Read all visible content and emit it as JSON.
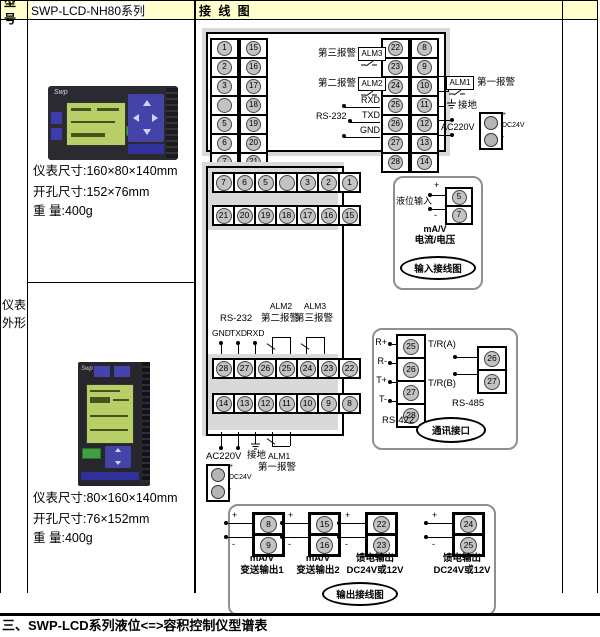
{
  "header": {
    "model_label": "型号",
    "series_label": "SWP-LCD-NH80系列",
    "wiring_label": "接 线 图"
  },
  "sidebar": {
    "label": "仪表外形",
    "device1": {
      "brand": "Swp",
      "size": "仪表尺寸:160×80×140mm",
      "cutout": "开孔尺寸:152×76mm",
      "weight": "重 量:400g"
    },
    "device2": {
      "brand": "Swp",
      "size": "仪表尺寸:80×160×140mm",
      "cutout": "开孔尺寸:76×152mm",
      "weight": "重 量:400g"
    }
  },
  "diagram_top": {
    "left_col1": [
      "1",
      "2",
      "3",
      "",
      "5",
      "6",
      "7"
    ],
    "left_col2": [
      "15",
      "16",
      "17",
      "18",
      "19",
      "20",
      "21"
    ],
    "right_col1": [
      "22",
      "23",
      "24",
      "25",
      "26",
      "27",
      "28"
    ],
    "right_col2": [
      "8",
      "9",
      "10",
      "11",
      "12",
      "13",
      "14"
    ],
    "labels": {
      "alarm3_text": "第三报警",
      "alarm3_tag": "ALM3",
      "alarm2_text": "第二报警",
      "alarm2_tag": "ALM2",
      "rxd": "RXD",
      "rs232": "RS-232",
      "txd": "TXD",
      "gnd": "GND",
      "alm1_tag": "ALM1",
      "alarm1_text": "第一报警",
      "ground": "接地",
      "ac": "AC220V",
      "dc": "DC24V",
      "plus": "+",
      "minus": "-"
    }
  },
  "diagram_rear": {
    "row1": [
      "7",
      "6",
      "5",
      "",
      "3",
      "2",
      "1"
    ],
    "row2": [
      "21",
      "20",
      "19",
      "18",
      "17",
      "16",
      "15"
    ],
    "row3": [
      "28",
      "27",
      "26",
      "25",
      "24",
      "23",
      "22"
    ],
    "row4": [
      "14",
      "13",
      "12",
      "11",
      "10",
      "9",
      "8"
    ],
    "labels": {
      "rs232": "RS-232",
      "gnd": "GND",
      "txd": "TXD",
      "rxd": "RXD",
      "alm2_tag": "ALM2",
      "alarm2_text": "第二报警",
      "alm3_tag": "ALM3",
      "alarm3_text": "第三报警",
      "ac": "AC220V",
      "ground": "接地",
      "alm1_tag": "ALM1",
      "alarm1_text": "第一报警",
      "dc": "DC24V",
      "plus": "+",
      "minus": "-"
    }
  },
  "input_box": {
    "level_label": "液位输入",
    "plus": "+",
    "minus": "-",
    "terminal_top": "5",
    "terminal_bottom": "7",
    "signal_line1": "mA/V",
    "signal_line2": "电流/电压",
    "caption": "输入接线图"
  },
  "comm_box": {
    "rs422": {
      "label": "RS-422",
      "pin_names": [
        "R+",
        "R-",
        "T+",
        "T-"
      ],
      "terminals": [
        "25",
        "26",
        "27",
        "28"
      ]
    },
    "rs485": {
      "label": "RS-485",
      "line_a": "T/R(A)",
      "line_b": "T/R(B)",
      "terminals": [
        "26",
        "27"
      ]
    },
    "caption": "通讯接口"
  },
  "output_box": {
    "caption": "输出接线图",
    "pairs": [
      {
        "plus": "+",
        "minus": "-",
        "t_plus": "8",
        "t_minus": "9",
        "line1": "mA/V",
        "line2": "变送输出1"
      },
      {
        "plus": "+",
        "minus": "-",
        "t_plus": "15",
        "t_minus": "16",
        "line1": "mA/V",
        "line2": "变送输出2"
      },
      {
        "plus": "+",
        "minus": "-",
        "t_plus": "22",
        "t_minus": "23",
        "line1": "馈电输出",
        "line2": "DC24V或12V"
      },
      {
        "plus": "+",
        "minus": "-",
        "t_plus": "24",
        "t_minus": "25",
        "line1": "馈电输出",
        "line2": "DC24V或12V"
      }
    ]
  },
  "footer": {
    "text": "三、SWP-LCD系列液位<=>容积控制仪型谱表"
  }
}
